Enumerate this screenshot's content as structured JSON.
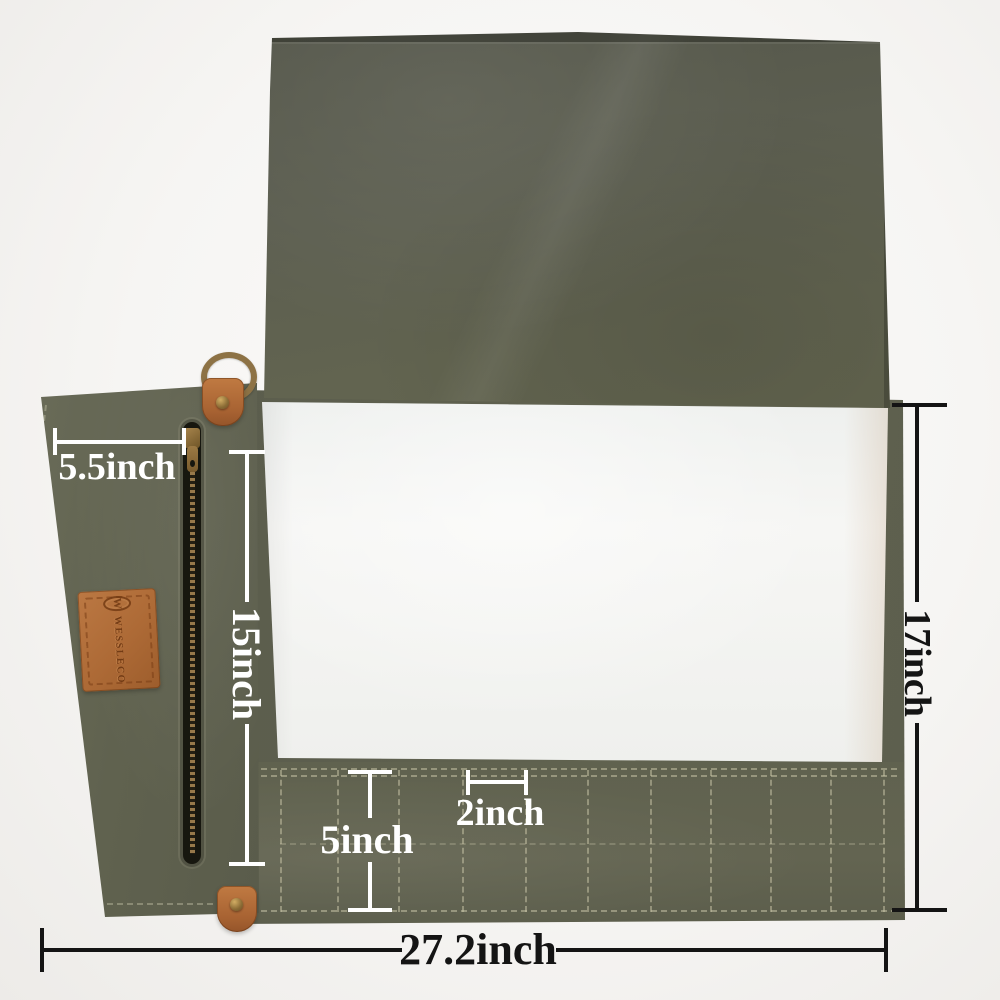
{
  "image": {
    "description": "Olive waxed-canvas knife roll photographed opened flat on a white backdrop, annotated with measurement callouts",
    "background_color": "#f6f5f3"
  },
  "colors": {
    "canvas_olive": "#5f6150",
    "canvas_olive_dark": "#54564a",
    "canvas_olive_light": "#696b58",
    "lining_white": "#f4f4f3",
    "leather_tan": "#b26f3c",
    "brass": "#8f7545",
    "stitch": "#cec9ab",
    "annotation_white": "#ffffff",
    "annotation_black": "#141414"
  },
  "brand": {
    "patch_logo_text": "WESSLECO",
    "patch_emblem_letter": "W"
  },
  "annotations": {
    "zip_pocket_width": {
      "label": "5.5inch"
    },
    "left_panel_length": {
      "label": "15inch"
    },
    "open_height": {
      "label": "17inch"
    },
    "slot_width": {
      "label": "2inch"
    },
    "slot_depth": {
      "label": "5inch"
    },
    "total_width": {
      "label": "27.2inch"
    }
  },
  "construction": {
    "slot_count": 10
  }
}
